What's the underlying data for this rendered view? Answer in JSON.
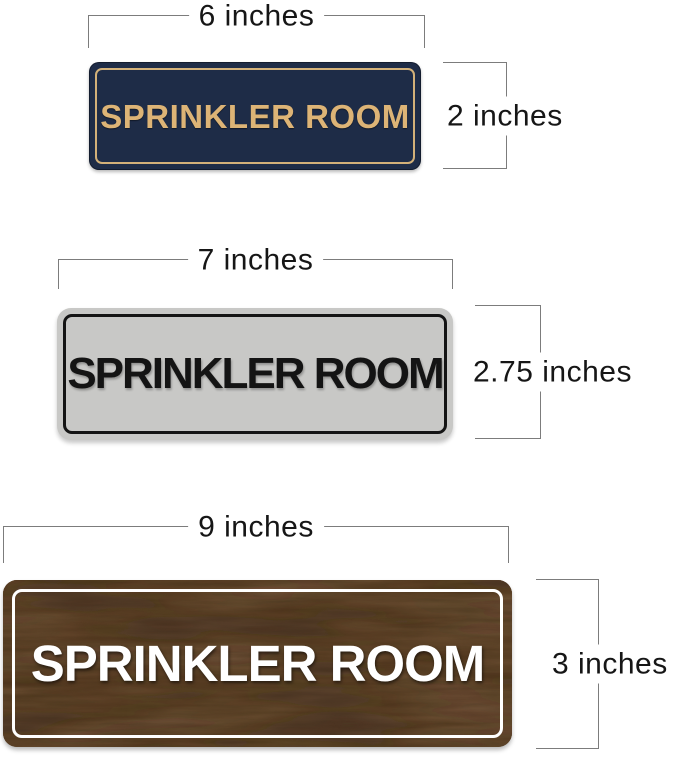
{
  "page": {
    "background": "#ffffff"
  },
  "annotation": {
    "line_color": "#7c7c7c",
    "text_color": "#161616"
  },
  "signs": [
    {
      "id": "navy-gold-sign",
      "label": "SPRINKLER ROOM",
      "width_label": "6 inches",
      "height_label": "2 inches",
      "colors": {
        "face": "#1e2c47",
        "border": "#d3b179",
        "text": "#ddb476"
      }
    },
    {
      "id": "silver-black-sign",
      "label": "SPRINKLER ROOM",
      "width_label": "7 inches",
      "height_label": "2.75 inches",
      "colors": {
        "face": "#c8c8c6",
        "border": "#141414",
        "text": "#141414"
      }
    },
    {
      "id": "walnut-wood-sign",
      "label": "SPRINKLER ROOM",
      "width_label": "9 inches",
      "height_label": "3 inches",
      "colors": {
        "face": "#5a4129",
        "border": "#ffffff",
        "text": "#ffffff",
        "grain_light": "#8a664a",
        "grain_dark": "#33220f"
      }
    }
  ]
}
